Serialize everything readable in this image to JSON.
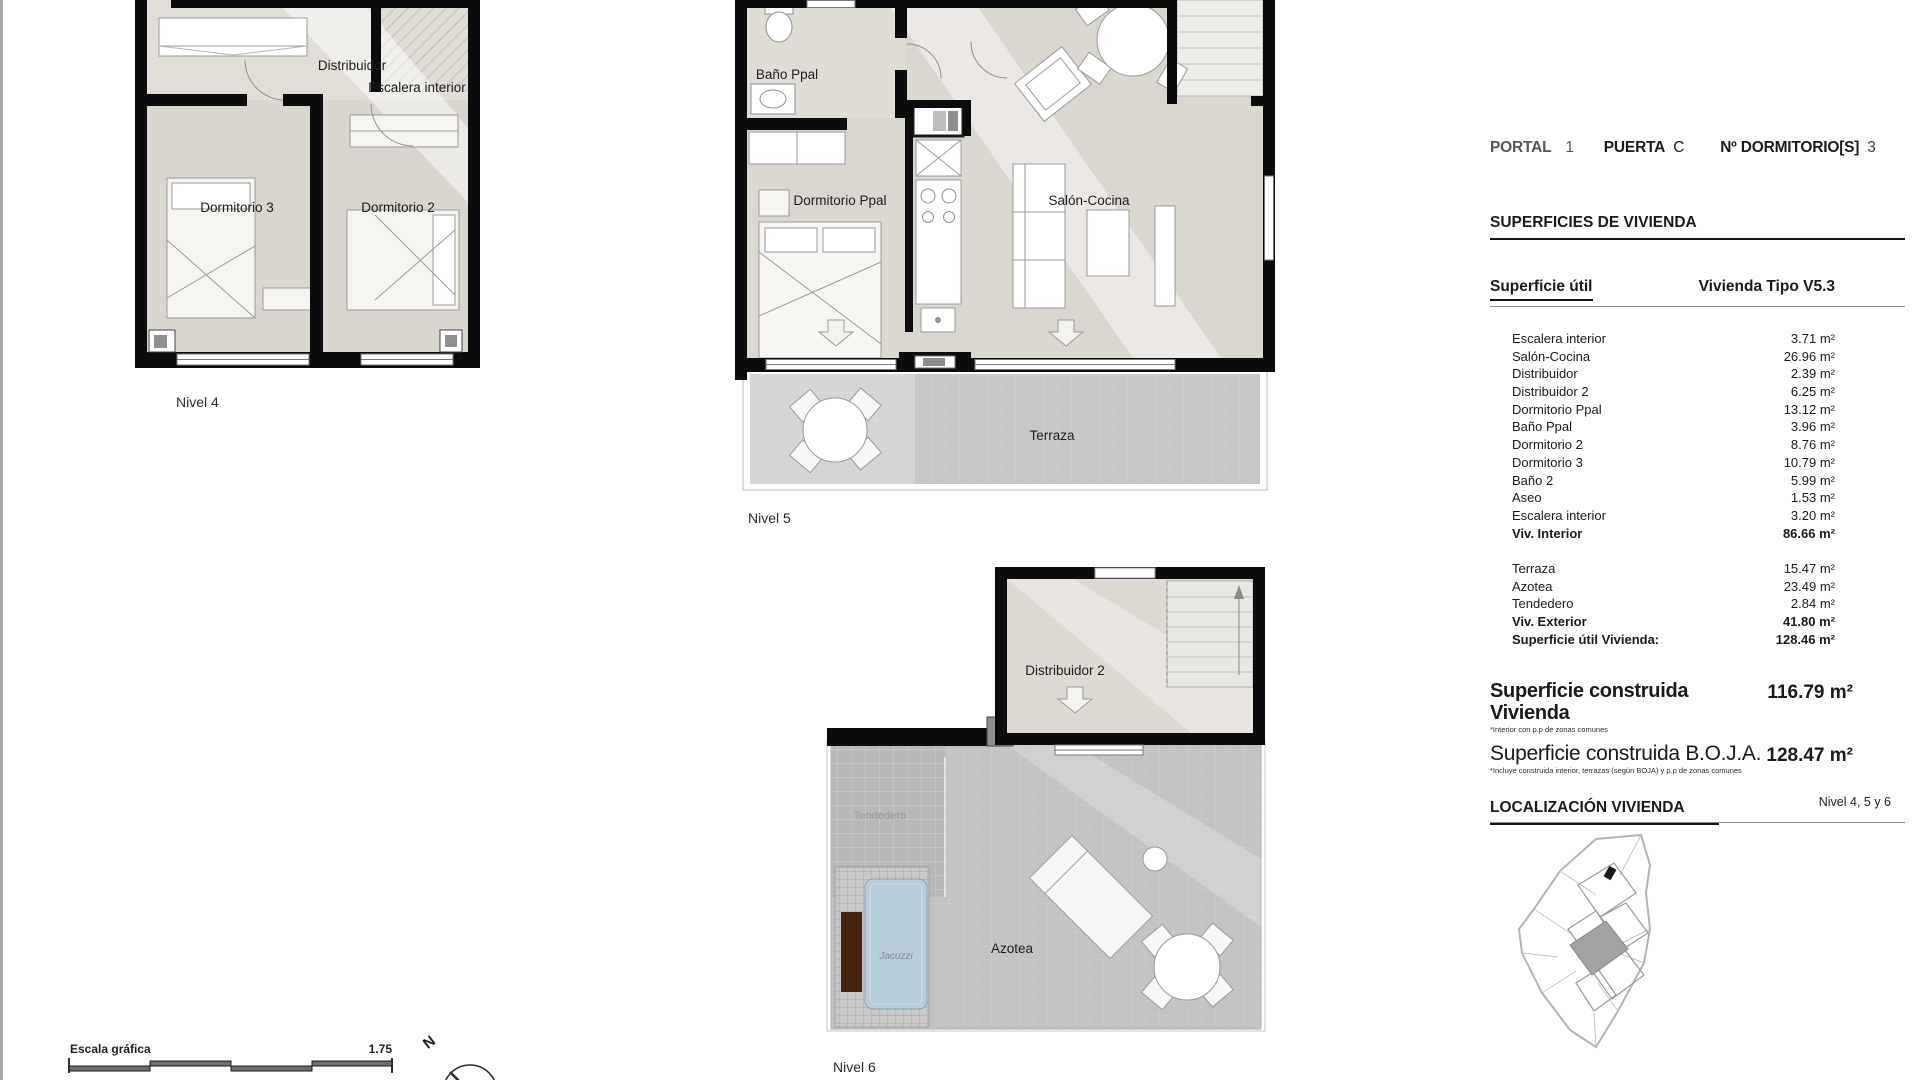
{
  "header": {
    "portal_label": "PORTAL",
    "portal_value": "1",
    "puerta_label": "PUERTA",
    "puerta_value": "C",
    "dorm_label": "Nº DORMITORIO[S]",
    "dorm_value": "3"
  },
  "superficies": {
    "section_title": "SUPERFICIES DE VIVIENDA",
    "util_label": "Superficie útil",
    "tipo_label": "Vivienda Tipo V5.3",
    "interior_rows": [
      {
        "label": "Escalera interior",
        "value": "3.71 m²",
        "bold": false
      },
      {
        "label": "Salón-Cocina",
        "value": "26.96 m²",
        "bold": false
      },
      {
        "label": "Distribuidor",
        "value": "2.39 m²",
        "bold": false
      },
      {
        "label": "Distribuidor 2",
        "value": "6.25 m²",
        "bold": false
      },
      {
        "label": "Dormitorio Ppal",
        "value": "13.12 m²",
        "bold": false
      },
      {
        "label": "Baño Ppal",
        "value": "3.96 m²",
        "bold": false
      },
      {
        "label": "Dormitorio 2",
        "value": "8.76 m²",
        "bold": false
      },
      {
        "label": "Dormitorio 3",
        "value": "10.79 m²",
        "bold": false
      },
      {
        "label": "Baño 2",
        "value": "5.99 m²",
        "bold": false
      },
      {
        "label": "Aseo",
        "value": "1.53 m²",
        "bold": false
      },
      {
        "label": "Escalera interior",
        "value": "3.20 m²",
        "bold": false
      },
      {
        "label": "Viv. Interior",
        "value": "86.66 m²",
        "bold": true
      }
    ],
    "exterior_rows": [
      {
        "label": "Terraza",
        "value": "15.47 m²",
        "bold": false
      },
      {
        "label": "Azotea",
        "value": "23.49 m²",
        "bold": false
      },
      {
        "label": "Tendedero",
        "value": "2.84 m²",
        "bold": false
      },
      {
        "label": "Viv. Exterior",
        "value": "41.80 m²",
        "bold": true
      },
      {
        "label": "Superficie útil Vivienda:",
        "value": "128.46 m²",
        "bold": true
      }
    ],
    "construida": [
      {
        "label": "Superficie construida Vivienda",
        "value": "116.79 m²",
        "note": "*Interior con p.p de zonas comunes",
        "label_bold": true
      },
      {
        "label": "Superficie construida B.O.J.A.",
        "value": "128.47 m²",
        "note": "*Incluye construida interior, terrazas (según BOJA) y p.p de zonas comunes",
        "label_bold": false
      }
    ]
  },
  "localizacion": {
    "section_title": "LOCALIZACIÓN VIVIENDA",
    "nivel_label": "Nivel 4, 5 y 6"
  },
  "plans": {
    "n4": {
      "caption": "Nivel 4",
      "distribuidor": "Distribuidor",
      "escalera": "Escalera interior",
      "dorm3": "Dormitorio 3",
      "dorm2": "Dormitorio 2"
    },
    "n5": {
      "caption": "Nivel 5",
      "bano": "Baño Ppal",
      "dorm_ppal": "Dormitorio Ppal",
      "salon": "Salón-Cocina",
      "terraza": "Terraza"
    },
    "n6": {
      "caption": "Nivel 6",
      "distribuidor2": "Distribuidor 2",
      "tendedero": "Tendedero",
      "jacuzzi": "Jacuzzi",
      "azotea": "Azotea"
    }
  },
  "scale_bar": {
    "label": "Escala gráfica",
    "ratio": "1.75",
    "north": "N"
  },
  "colors": {
    "wall": "#0c0c0c",
    "floor": "#dad6d0",
    "terrace": "#c7c7c7",
    "jacuzzi": "#b7cdd9",
    "bench": "#45230e",
    "accent_gray": "#9a9a9a"
  }
}
